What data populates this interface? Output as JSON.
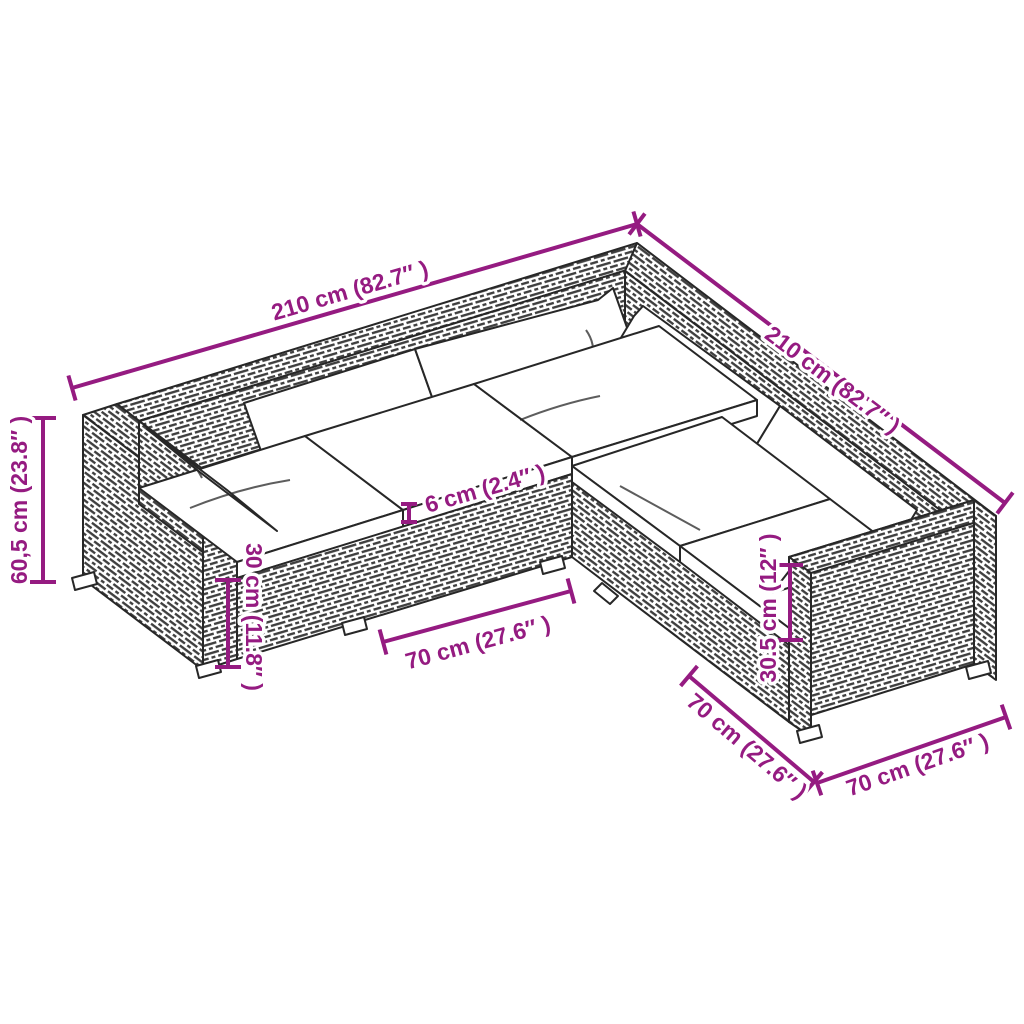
{
  "diagram": {
    "type": "product-dimension-diagram",
    "subject": "5-piece L-shaped poly rattan garden lounge set with cushions",
    "background": "#ffffff",
    "accent": "#951b81",
    "outline": "#272727"
  },
  "illustration": {
    "seat_modules": 5,
    "seat_cushions": 5,
    "back_cushions": 6,
    "armrests": 2,
    "texture": "poly rattan weave hatching",
    "cushion_color": "white"
  },
  "dims": {
    "back_left": {
      "label": "210 cm (82.7″ )",
      "value": "210 cm",
      "imperial": "82.7″"
    },
    "back_right": {
      "label": "210 cm (82.7″ )",
      "value": "210 cm",
      "imperial": "82.7″"
    },
    "height": {
      "label": "60,5 cm (23.8″ )",
      "value": "60,5 cm",
      "imperial": "23.8″"
    },
    "base_height": {
      "label": "30 cm (11.8″ )",
      "value": "30 cm",
      "imperial": "11.8″"
    },
    "cushion": {
      "label": "6 cm (2.4″ )",
      "value": "6 cm",
      "imperial": "2.4″"
    },
    "module_front": {
      "label": "70 cm (27.6″ )",
      "value": "70 cm",
      "imperial": "27.6″"
    },
    "seat_height_right": {
      "label": "30.5 cm (12″ )",
      "value": "30.5 cm",
      "imperial": "12″"
    },
    "depth_right": {
      "label": "70 cm (27.6″ )",
      "value": "70 cm",
      "imperial": "27.6″"
    },
    "module_right": {
      "label": "70 cm (27.6″ )",
      "value": "70 cm",
      "imperial": "27.6″"
    }
  }
}
